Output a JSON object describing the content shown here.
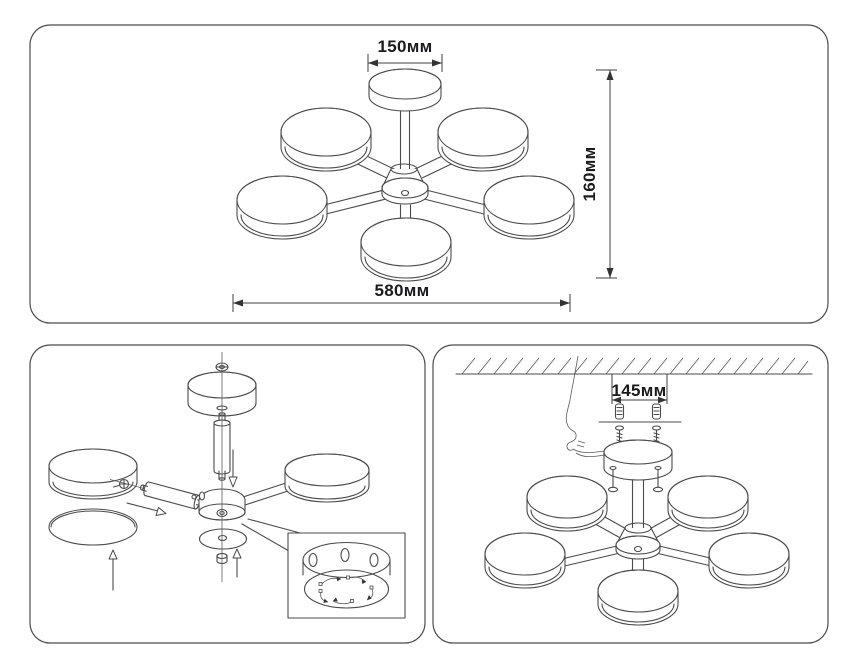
{
  "drawing": {
    "kind": "ceiling chandelier technical drawing, 3 panels",
    "colors": {
      "background": "#ffffff",
      "panel_border": "#4c4c4c",
      "line": "#4b4b4b",
      "text": "#1b1b1d"
    }
  },
  "panels": {
    "top_view": {
      "dimensions": {
        "canopy_width": "150мм",
        "fixture_height": "160мм",
        "fixture_width": "580мм"
      }
    },
    "assembly_view": {
      "description": "exploded assembly of canopy, rod, hub, shades and detail inset"
    },
    "mounting_view": {
      "dimensions": {
        "mounting_hole_spacing": "145мм"
      }
    }
  }
}
